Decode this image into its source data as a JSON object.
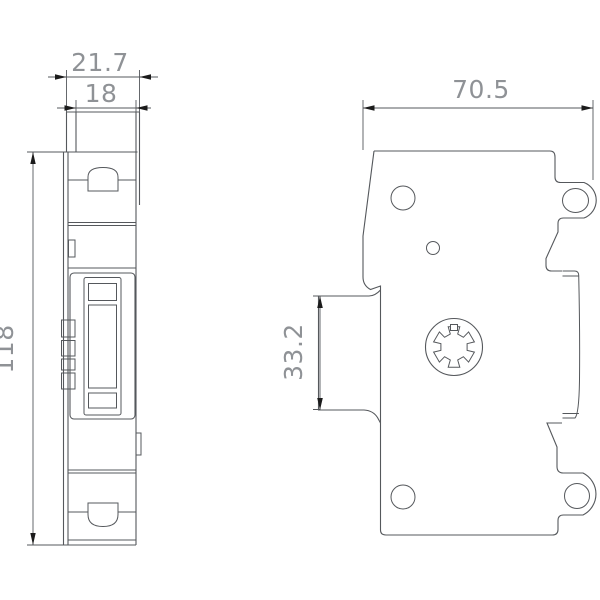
{
  "drawing": {
    "kind": "technical-dimension-drawing",
    "background": "#ffffff",
    "line_color": "#55585c",
    "text_color": "#8f9296",
    "arrow_color": "#1b1b1b",
    "dimensions": {
      "outer_width": "21.7",
      "module_width": "18",
      "depth": "70.5",
      "din_rail_height": "33.2",
      "height": "118"
    }
  }
}
